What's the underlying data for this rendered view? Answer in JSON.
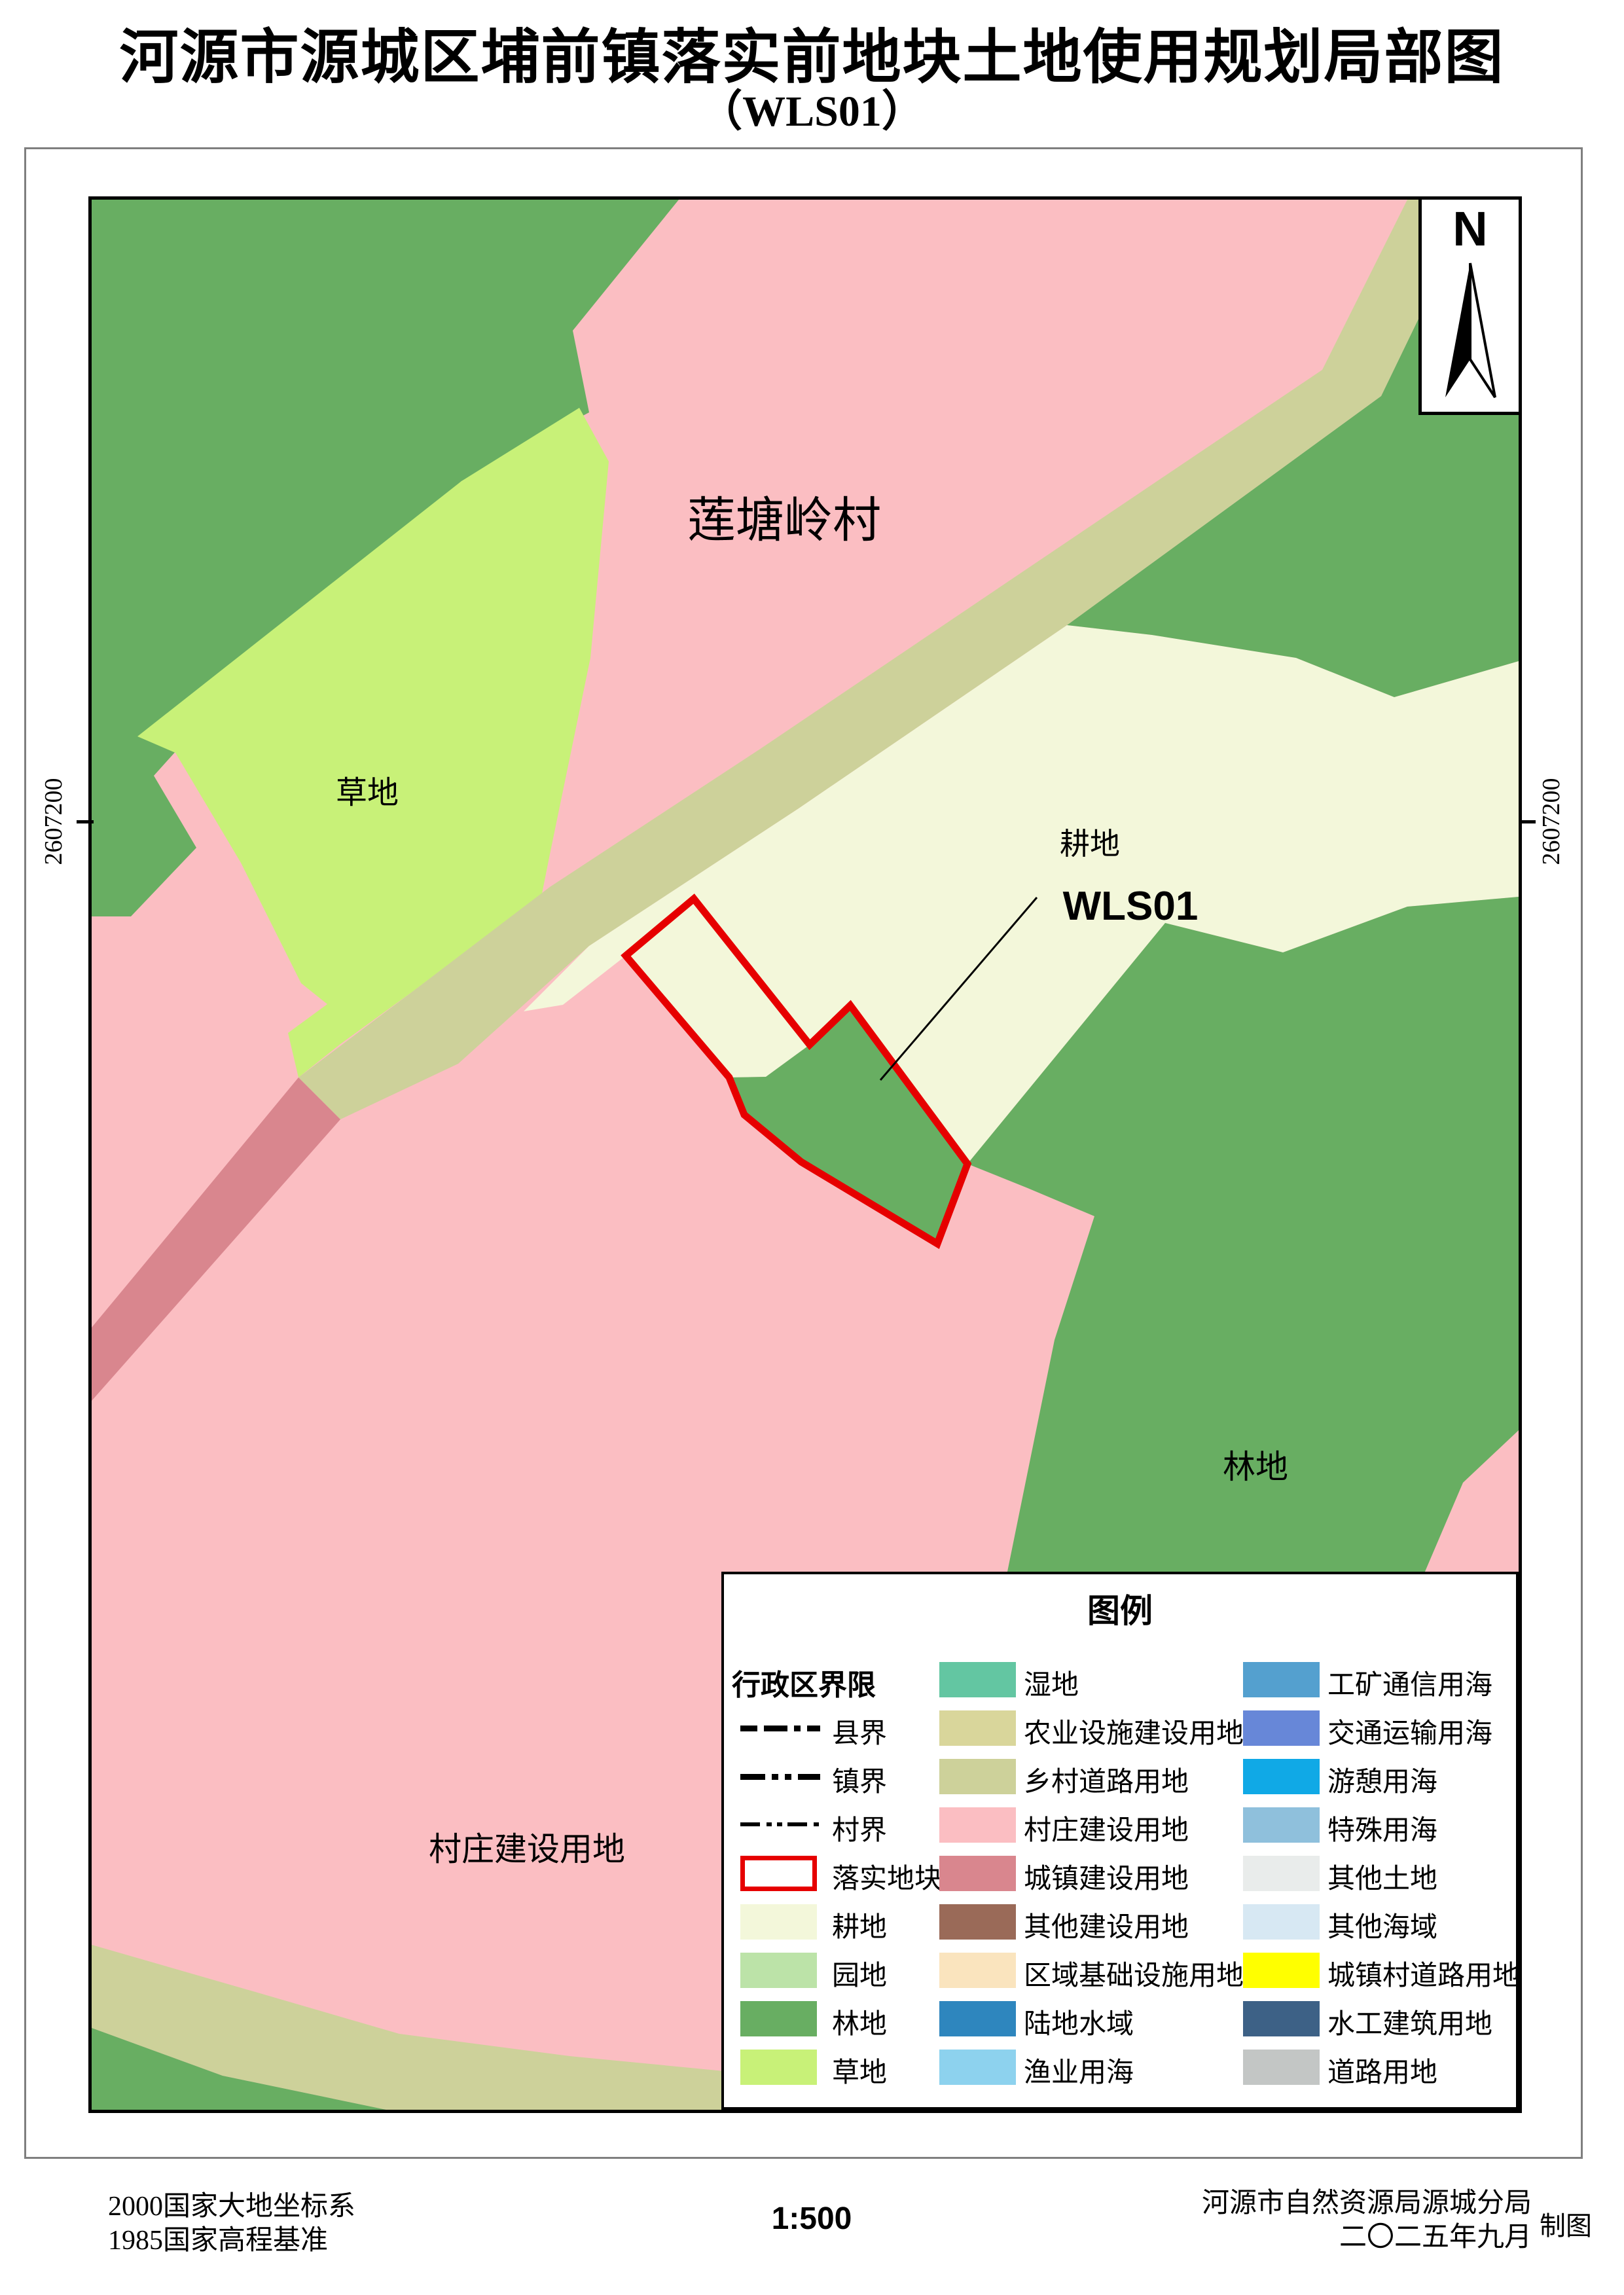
{
  "title": {
    "line1": "河源市源城区埔前镇落实前地块土地使用规划局部图",
    "line2": "（WLS01）"
  },
  "north_label": "N",
  "coordinate_tick": "2607200",
  "map": {
    "labels": {
      "village_name": "莲塘岭村",
      "grass": "草地",
      "cropland": "耕地",
      "parcel_code": "WLS01",
      "forest": "林地",
      "village_construction": "村庄建设用地"
    },
    "colors": {
      "village_pink": "#FBBEC2",
      "forest_green": "#68AE62",
      "grass_green": "#C8F178",
      "cropland_cream": "#F3F7DA",
      "rural_road_khaki": "#CDD19A",
      "town_construction_pink": "#D9868E",
      "parcel_red": "#E60000",
      "leader_black": "#000000"
    }
  },
  "legend": {
    "title": "图例",
    "columns": [
      {
        "rows": [
          {
            "type": "header",
            "label": "行政区界限"
          },
          {
            "type": "line",
            "style": "county",
            "label": "县界"
          },
          {
            "type": "line",
            "style": "town",
            "label": "镇界"
          },
          {
            "type": "line",
            "style": "village",
            "label": "村界"
          },
          {
            "type": "outline",
            "label": "落实地块",
            "color": "#E60000"
          },
          {
            "type": "swatch",
            "label": "耕地",
            "color": "#F3F7DA"
          },
          {
            "type": "swatch",
            "label": "园地",
            "color": "#BCE3A8"
          },
          {
            "type": "swatch",
            "label": "林地",
            "color": "#68AE62"
          },
          {
            "type": "swatch",
            "label": "草地",
            "color": "#C8F178"
          }
        ]
      },
      {
        "rows": [
          {
            "type": "swatch",
            "label": "湿地",
            "color": "#63C6A2"
          },
          {
            "type": "swatch",
            "label": "农业设施建设用地",
            "color": "#D9D69B"
          },
          {
            "type": "swatch",
            "label": "乡村道路用地",
            "color": "#CDD19A"
          },
          {
            "type": "swatch",
            "label": "村庄建设用地",
            "color": "#FBBEC2"
          },
          {
            "type": "swatch",
            "label": "城镇建设用地",
            "color": "#D9868E"
          },
          {
            "type": "swatch",
            "label": "其他建设用地",
            "color": "#9A6A58"
          },
          {
            "type": "swatch",
            "label": "区域基础设施用地",
            "color": "#FAE4BE"
          },
          {
            "type": "swatch",
            "label": "陆地水域",
            "color": "#2E86BE"
          },
          {
            "type": "swatch",
            "label": "渔业用海",
            "color": "#8DD2EE"
          }
        ]
      },
      {
        "rows": [
          {
            "type": "swatch",
            "label": "工矿通信用海",
            "color": "#54A0CF"
          },
          {
            "type": "swatch",
            "label": "交通运输用海",
            "color": "#6787D8"
          },
          {
            "type": "swatch",
            "label": "游憩用海",
            "color": "#10A9E6"
          },
          {
            "type": "swatch",
            "label": "特殊用海",
            "color": "#8FC0DC"
          },
          {
            "type": "swatch",
            "label": "其他土地",
            "color": "#E9ECEB"
          },
          {
            "type": "swatch",
            "label": "其他海域",
            "color": "#D7E8F3"
          },
          {
            "type": "swatch",
            "label": "城镇村道路用地",
            "color": "#FFFF00"
          },
          {
            "type": "swatch",
            "label": "水工建筑用地",
            "color": "#3D6186"
          },
          {
            "type": "swatch",
            "label": "道路用地",
            "color": "#C3C6C5"
          }
        ]
      }
    ]
  },
  "footer": {
    "datum_line1": "2000国家大地坐标系",
    "datum_line2": "1985国家高程基准",
    "scale": "1:500",
    "agency": "河源市自然资源局源城分局",
    "date": "二〇二五年九月",
    "maker": "制图"
  }
}
